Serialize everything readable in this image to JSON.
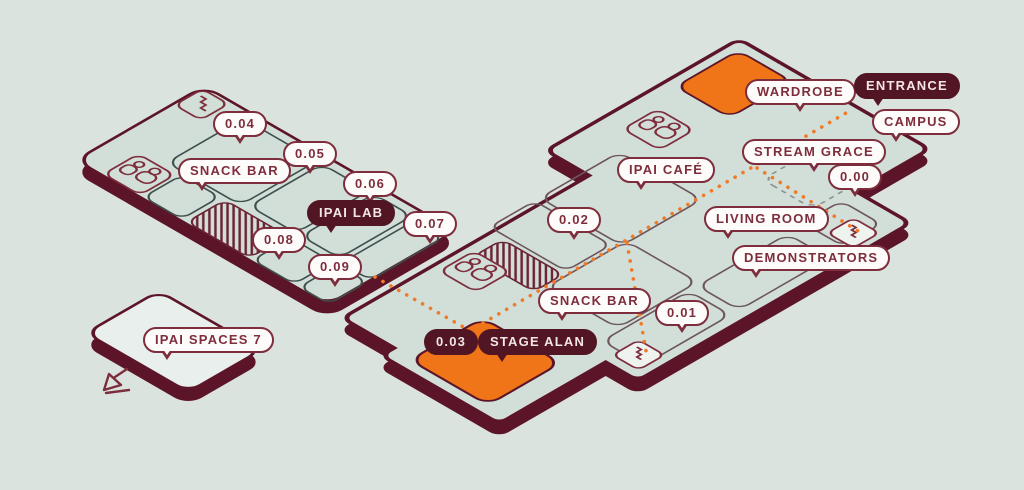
{
  "colors": {
    "background": "#dbe3df",
    "floor": "#d2dfd9",
    "floor_light": "#e9efec",
    "outline_maroon": "#5c1528",
    "label_maroon": "#7e2d3c",
    "accent_orange": "#f07418",
    "route_orange": "#ef7b28"
  },
  "bubbles": {
    "room_004": {
      "label": "0.04"
    },
    "room_005": {
      "label": "0.05"
    },
    "snack_bar_left": {
      "label": "SNACK BAR"
    },
    "room_006": {
      "label": "0.06"
    },
    "ipai_lab": {
      "label": "IPAI LAB"
    },
    "room_007": {
      "label": "0.07"
    },
    "room_008": {
      "label": "0.08"
    },
    "room_009": {
      "label": "0.09"
    },
    "ipai_spaces_7": {
      "label": "IPAI SPACES 7"
    },
    "room_003": {
      "label": "0.03"
    },
    "stage_alan": {
      "label": "STAGE ALAN"
    },
    "snack_bar_right": {
      "label": "SNACK BAR"
    },
    "room_001": {
      "label": "0.01"
    },
    "room_002": {
      "label": "0.02"
    },
    "ipai_cafe": {
      "label": "IPAI CAFÉ"
    },
    "wardrobe": {
      "label": "WARDROBE"
    },
    "entrance": {
      "label": "ENTRANCE"
    },
    "campus": {
      "label": "CAMPUS"
    },
    "stream_grace": {
      "label": "STREAM GRACE"
    },
    "room_000": {
      "label": "0.00"
    },
    "living_room": {
      "label": "LIVING ROOM"
    },
    "demonstrators": {
      "label": "DEMONSTRATORS"
    }
  },
  "icons": {
    "stairs": "staircase-zigzag",
    "people": "two-people-room",
    "direction_arrow": "arrow-down-left",
    "route_style": "orange-dotted-path"
  }
}
